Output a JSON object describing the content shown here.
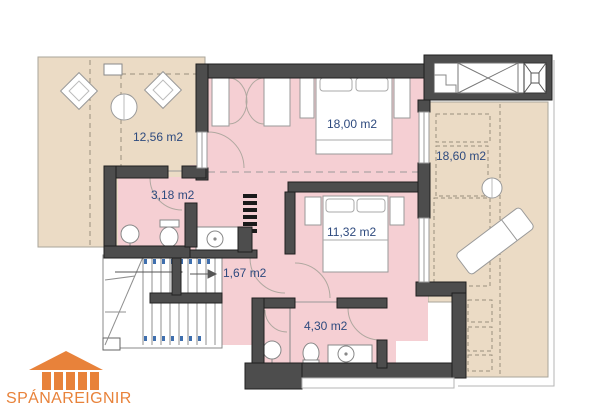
{
  "plan_title": "floor-plan",
  "rooms": [
    {
      "id": "terrace-left",
      "label": "12,56 m2"
    },
    {
      "id": "bedroom-main",
      "label": "18,00 m2"
    },
    {
      "id": "terrace-right",
      "label": "18,60 m2"
    },
    {
      "id": "bathroom-small",
      "label": "3,18 m2"
    },
    {
      "id": "bedroom-second",
      "label": "11,32 m2"
    },
    {
      "id": "landing",
      "label": "1,67 m2"
    },
    {
      "id": "bathroom-second",
      "label": "4,30 m2"
    }
  ],
  "logo": {
    "name": "SPÁNAREIGNIR"
  },
  "colors": {
    "room_fill": "#f5cfd3",
    "terrace_fill": "#ebdbc5",
    "wall": "#4d4d4d",
    "label_text": "#2e4a7e",
    "logo_orange": "#e8823a"
  }
}
